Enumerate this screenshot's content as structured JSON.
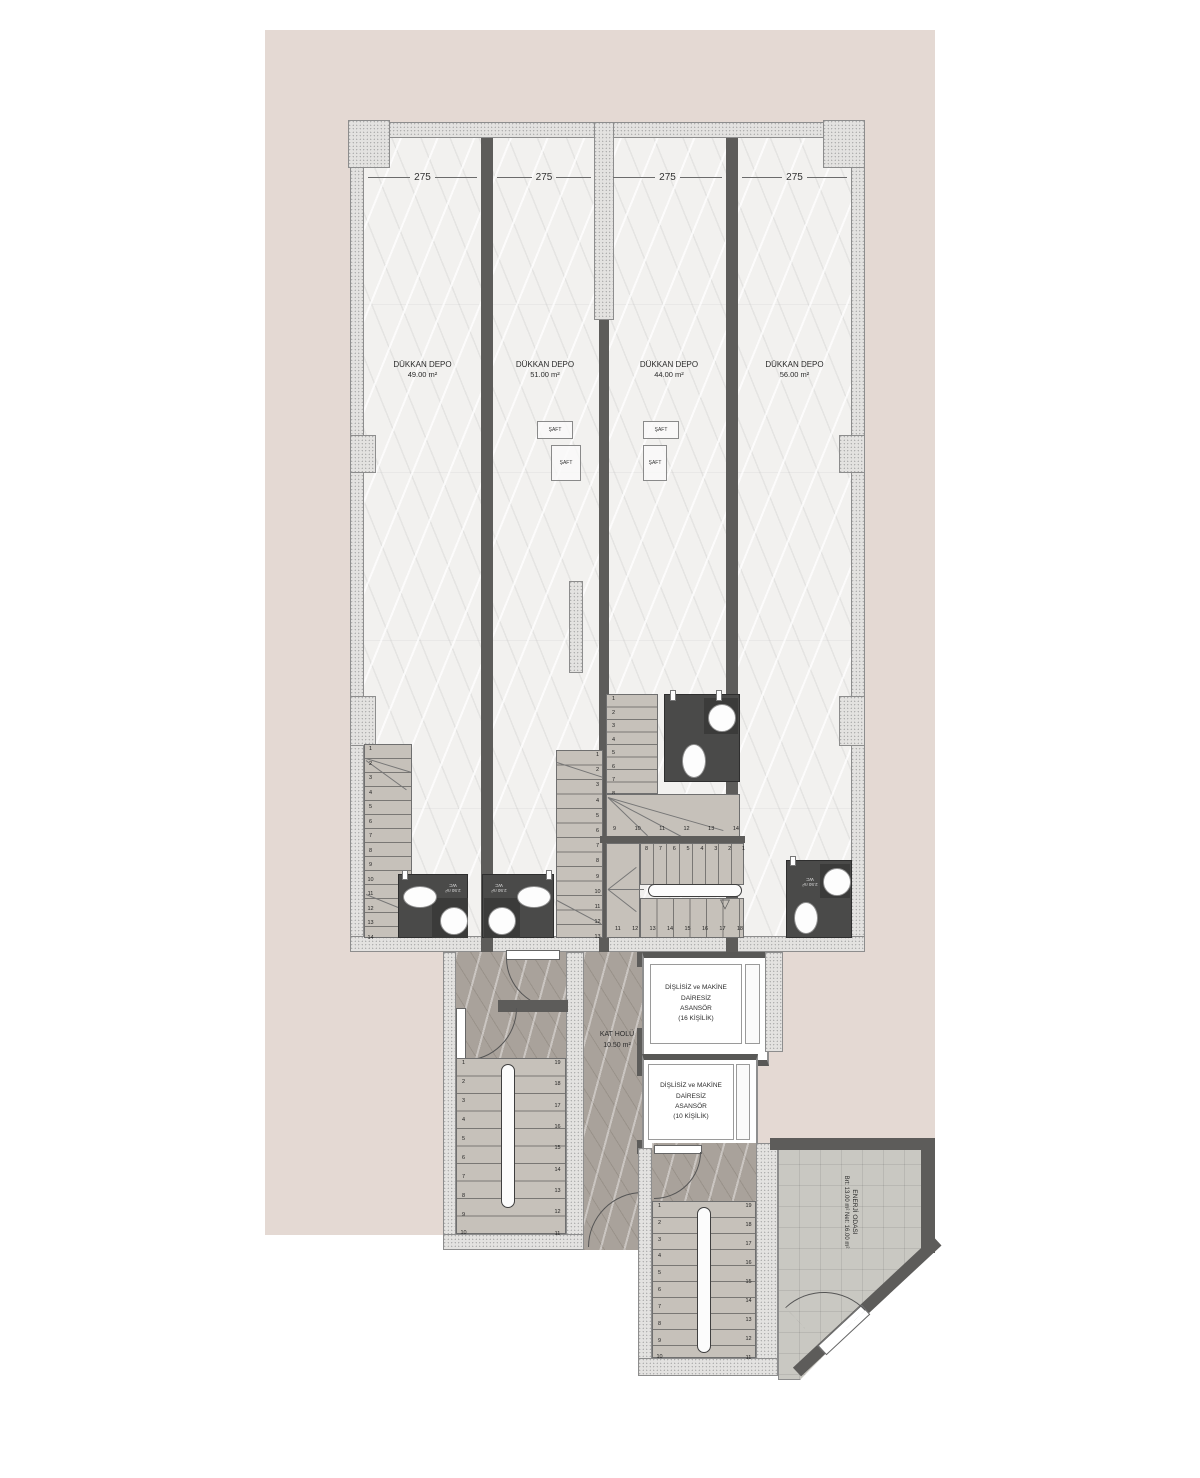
{
  "colors": {
    "site": "#e4d9d3",
    "wall_dark": "#5d5c5a",
    "wall_hatch": "#e3e2e0",
    "floor_light": "#f2f1ef",
    "hall_floor": "#a9a29b",
    "stair_floor": "#c6c1ba",
    "wc_dark": "#4a4a49",
    "tile_floor": "#c9c8c2"
  },
  "dimensions": {
    "bay_width": "275"
  },
  "shops": [
    {
      "name": "DÜKKAN DEPO",
      "area": "49.00 m²"
    },
    {
      "name": "DÜKKAN DEPO",
      "area": "51.00 m²"
    },
    {
      "name": "DÜKKAN DEPO",
      "area": "44.00 m²"
    },
    {
      "name": "DÜKKAN DEPO",
      "area": "56.00 m²"
    }
  ],
  "shaft": {
    "label": "ŞAFT"
  },
  "wc": {
    "label": "WC",
    "area": "2.50 m²"
  },
  "hall": {
    "name": "KAT HOLÜ",
    "area": "10.50 m²"
  },
  "elevators": [
    {
      "line1": "DİŞLİSİZ ve MAKİNE DAİRESİZ",
      "line2": "ASANSÖR",
      "line3": "(16 KİŞİLİK)"
    },
    {
      "line1": "DİŞLİSİZ ve MAKİNE DAİRESİZ",
      "line2": "ASANSÖR",
      "line3": "(10 KİŞİLİK)"
    }
  ],
  "energy_room": {
    "name": "ENERJİ ODASI",
    "detail": "Brt: 13.00 m² Net: 16.00 m²"
  },
  "stairs": {
    "s1": [
      "1",
      "2",
      "3",
      "4",
      "5",
      "6",
      "7",
      "8",
      "9",
      "10",
      "11",
      "12",
      "13",
      "14"
    ],
    "s2": [
      "1",
      "2",
      "3",
      "4",
      "5",
      "6",
      "7",
      "8",
      "9",
      "10",
      "11",
      "12",
      "13"
    ],
    "s3_flight": [
      "1",
      "2",
      "3",
      "4",
      "5",
      "6",
      "7",
      "8"
    ],
    "s3_turn": [
      "9",
      "10",
      "11",
      "12",
      "13",
      "14"
    ],
    "s4_top": [
      "8",
      "7",
      "6",
      "5",
      "4",
      "3",
      "2",
      "1"
    ],
    "s4_bottom": [
      "11",
      "12",
      "13",
      "14",
      "15",
      "16",
      "17",
      "18"
    ],
    "t1_left": [
      "1",
      "2",
      "3",
      "4",
      "5",
      "6",
      "7",
      "8",
      "9",
      "10"
    ],
    "t1_right": [
      "19",
      "18",
      "17",
      "16",
      "15",
      "14",
      "13",
      "12",
      "11"
    ],
    "t2_left": [
      "1",
      "2",
      "3",
      "4",
      "5",
      "6",
      "7",
      "8",
      "9",
      "10"
    ],
    "t2_right": [
      "19",
      "18",
      "17",
      "16",
      "15",
      "14",
      "13",
      "12",
      "11"
    ]
  }
}
